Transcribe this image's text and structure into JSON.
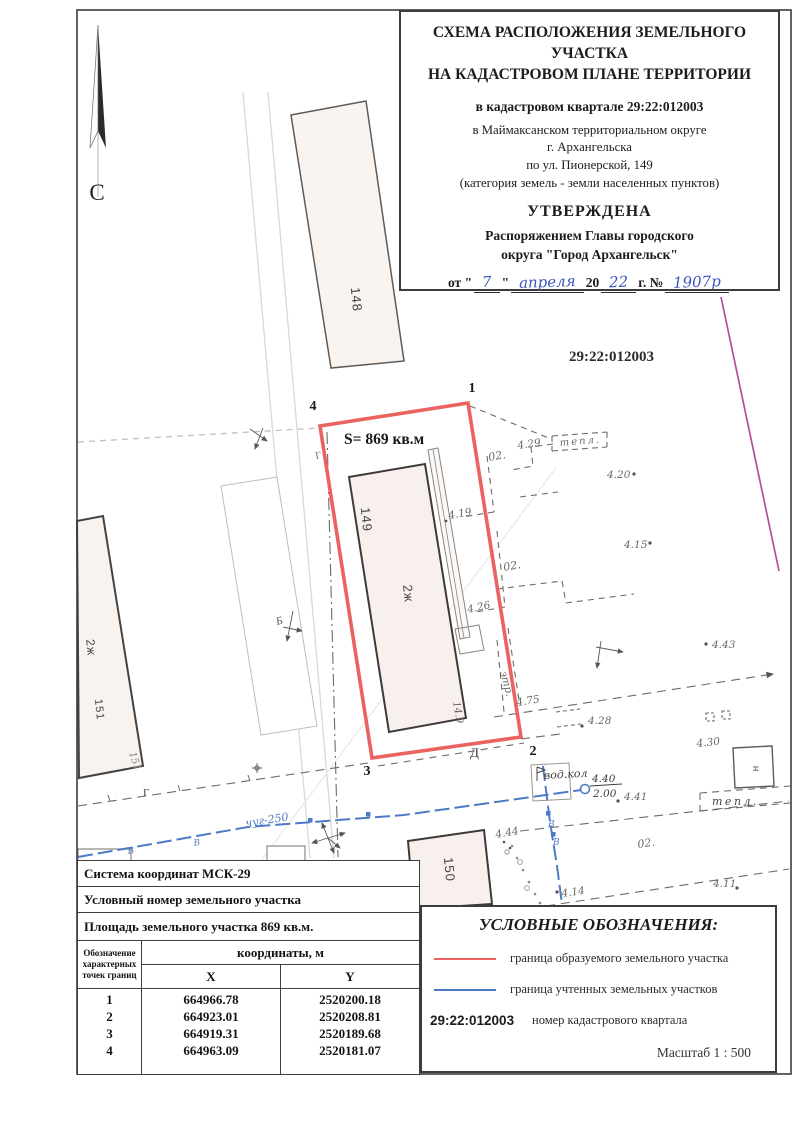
{
  "title_block": {
    "title_line1": "СХЕМА РАСПОЛОЖЕНИЯ ЗЕМЕЛЬНОГО УЧАСТКА",
    "title_line2": "НА КАДАСТРОВОМ ПЛАНЕ ТЕРРИТОРИИ",
    "quarter_line": "в кадастровом квартале 29:22:012003",
    "addr_line1": "в Маймаксанском территориальном округе",
    "addr_line2": "г. Архангельска",
    "addr_line3": "по ул. Пионерской, 149",
    "addr_line4": "(категория земель - земли населенных пунктов)",
    "approved": "УТВЕРЖДЕНА",
    "order_line1": "Распоряжением Главы городского",
    "order_line2": "округа \"Город Архангельск\"",
    "approval": {
      "prefix": "от \"",
      "day": "7",
      "infix": "\"",
      "month": "апреля",
      "year_prefix": "20",
      "year": "22",
      "suffix": "г. №",
      "number": "1907р"
    }
  },
  "map": {
    "north_label": "С",
    "cadastral_number": "29:22:012003",
    "area_label": "S= 869 кв.м",
    "buildings": {
      "b148": "148",
      "b149": "149",
      "b149_type": "2ж",
      "b149_len": "14.9",
      "b150": "150",
      "b151": "151",
      "b151_type": "2ж",
      "b151_hand": "151",
      "n_small": "н"
    },
    "points": {
      "p1": "1",
      "p2": "2",
      "p3": "3",
      "p4": "4"
    },
    "fence_d": "Д",
    "gas_g1": "Г",
    "gas_g2": "Г",
    "b_mark": "Б",
    "teplo_top": "тепл.",
    "teplo_bottom": "тепл.",
    "vodkol": "вод.кол",
    "well_top": "4.40",
    "well_bottom": "2.00",
    "pipe_label": "чуг-250",
    "water_v1": "В",
    "water_v2": "В",
    "water_v3": "В",
    "water_v4": "В",
    "etr": "этр.",
    "oz1": "02.",
    "oz2": "02.",
    "oz3": "02.",
    "elev": {
      "e429": "4.29",
      "e420": "4.20",
      "e415": "4.15",
      "e419": "4.19",
      "e426": "4.26",
      "e475": "4.75",
      "e443": "4.43",
      "e428": "4.28",
      "e430": "4.30",
      "e441": "4.41",
      "e444": "4.44",
      "e414": "4.14",
      "e411": "4.11"
    },
    "colors": {
      "plot_red": "#ea6360",
      "water_blue": "#4d7ac6",
      "quarter_magenta": "#b24f9b"
    }
  },
  "table": {
    "row1": "Система координат МСК-29",
    "row2": "Условный номер земельного участка",
    "row3": "Площадь земельного участка 869 кв.м.",
    "header_col1_line1": "Обозначение",
    "header_col1_line2": "характерных",
    "header_col1_line3": "точек границ",
    "header_coords": "координаты, м",
    "header_x": "X",
    "header_y": "Y",
    "points": [
      {
        "n": "1",
        "x": "664966.78",
        "y": "2520200.18"
      },
      {
        "n": "2",
        "x": "664923.01",
        "y": "2520208.81"
      },
      {
        "n": "3",
        "x": "664919.31",
        "y": "2520189.68"
      },
      {
        "n": "4",
        "x": "664963.09",
        "y": "2520181.07"
      }
    ]
  },
  "legend": {
    "title": "УСЛОВНЫЕ ОБОЗНАЧЕНИЯ:",
    "item1": "граница образуемого земельного участка",
    "item2": "граница учтенных земельных участков",
    "item3_code": "29:22:012003",
    "item3": "номер кадастрового квартала",
    "scale": "Масштаб  1 : 500"
  }
}
